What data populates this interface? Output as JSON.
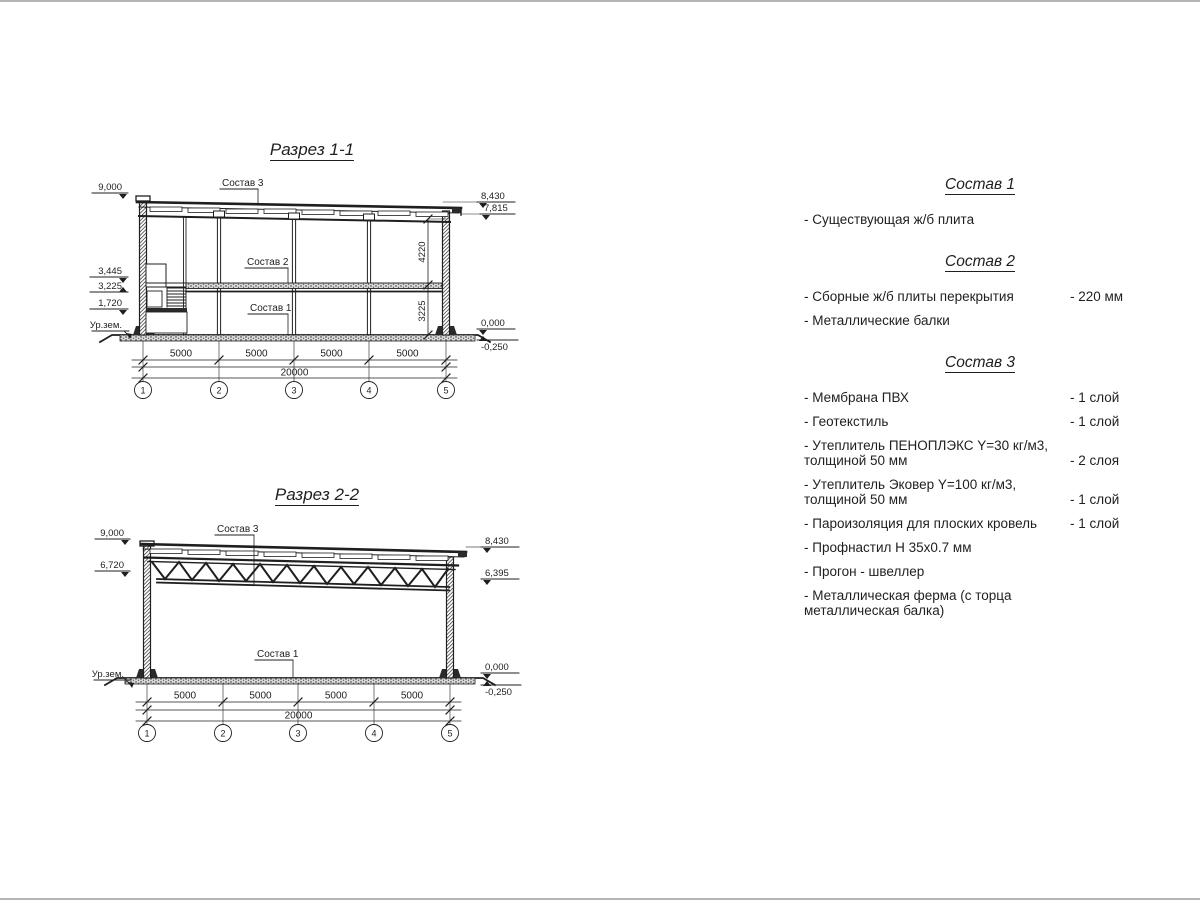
{
  "colors": {
    "line": "#1f1f1f",
    "edge": "#b5b5b5",
    "background": "#ffffff"
  },
  "s1": {
    "title": "Разрез 1-1",
    "label_sostav3": "Состав 3",
    "label_sostav2": "Состав 2",
    "label_sostav1": "Состав 1",
    "elev_left": [
      "9,000",
      "3,445",
      "3,225",
      "1,720"
    ],
    "ground": "Ур.зем.",
    "elev_right": [
      "8,430",
      "7,815",
      "0,000",
      "-0,250"
    ],
    "heights": [
      "4220",
      "3225"
    ],
    "spans": [
      "5000",
      "5000",
      "5000",
      "5000"
    ],
    "total": "20000",
    "axes": [
      "1",
      "2",
      "3",
      "4",
      "5"
    ]
  },
  "s2": {
    "title": "Разрез 2-2",
    "label_sostav3": "Состав 3",
    "label_sostav1": "Состав 1",
    "elev_left": [
      "9,000",
      "6,720"
    ],
    "ground": "Ур.зем.",
    "elev_right": [
      "8,430",
      "6,395",
      "0,000",
      "-0,250"
    ],
    "spans": [
      "5000",
      "5000",
      "5000",
      "5000"
    ],
    "total": "20000",
    "axes": [
      "1",
      "2",
      "3",
      "4",
      "5"
    ]
  },
  "legend": {
    "sections": [
      {
        "heading": "Состав 1",
        "items": [
          {
            "label": "- Существующая ж/б плита",
            "value": ""
          }
        ]
      },
      {
        "heading": "Состав 2",
        "items": [
          {
            "label": "- Сборные ж/б плиты перекрытия",
            "value": "- 220 мм"
          },
          {
            "label": "- Металлические балки",
            "value": ""
          }
        ]
      },
      {
        "heading": "Состав 3",
        "items": [
          {
            "label": "- Мембрана ПВХ",
            "value": "- 1 слой"
          },
          {
            "label": "- Геотекстиль",
            "value": "- 1 слой"
          },
          {
            "label": "- Утеплитель ПЕНОПЛЭКС Y=30 кг/м3, толщиной 50 мм",
            "value": "- 2 слоя"
          },
          {
            "label": "- Утеплитель Эковер Y=100 кг/м3, толщиной 50 мм",
            "value": "- 1 слой"
          },
          {
            "label": "- Пароизоляция для плоских кровель",
            "value": "- 1 слой"
          },
          {
            "label": "- Профнастил Н 35х0.7 мм",
            "value": ""
          },
          {
            "label": "- Прогон - швеллер",
            "value": ""
          },
          {
            "label": "- Металлическая ферма (с торца металлическая балка)",
            "value": ""
          }
        ]
      }
    ]
  }
}
